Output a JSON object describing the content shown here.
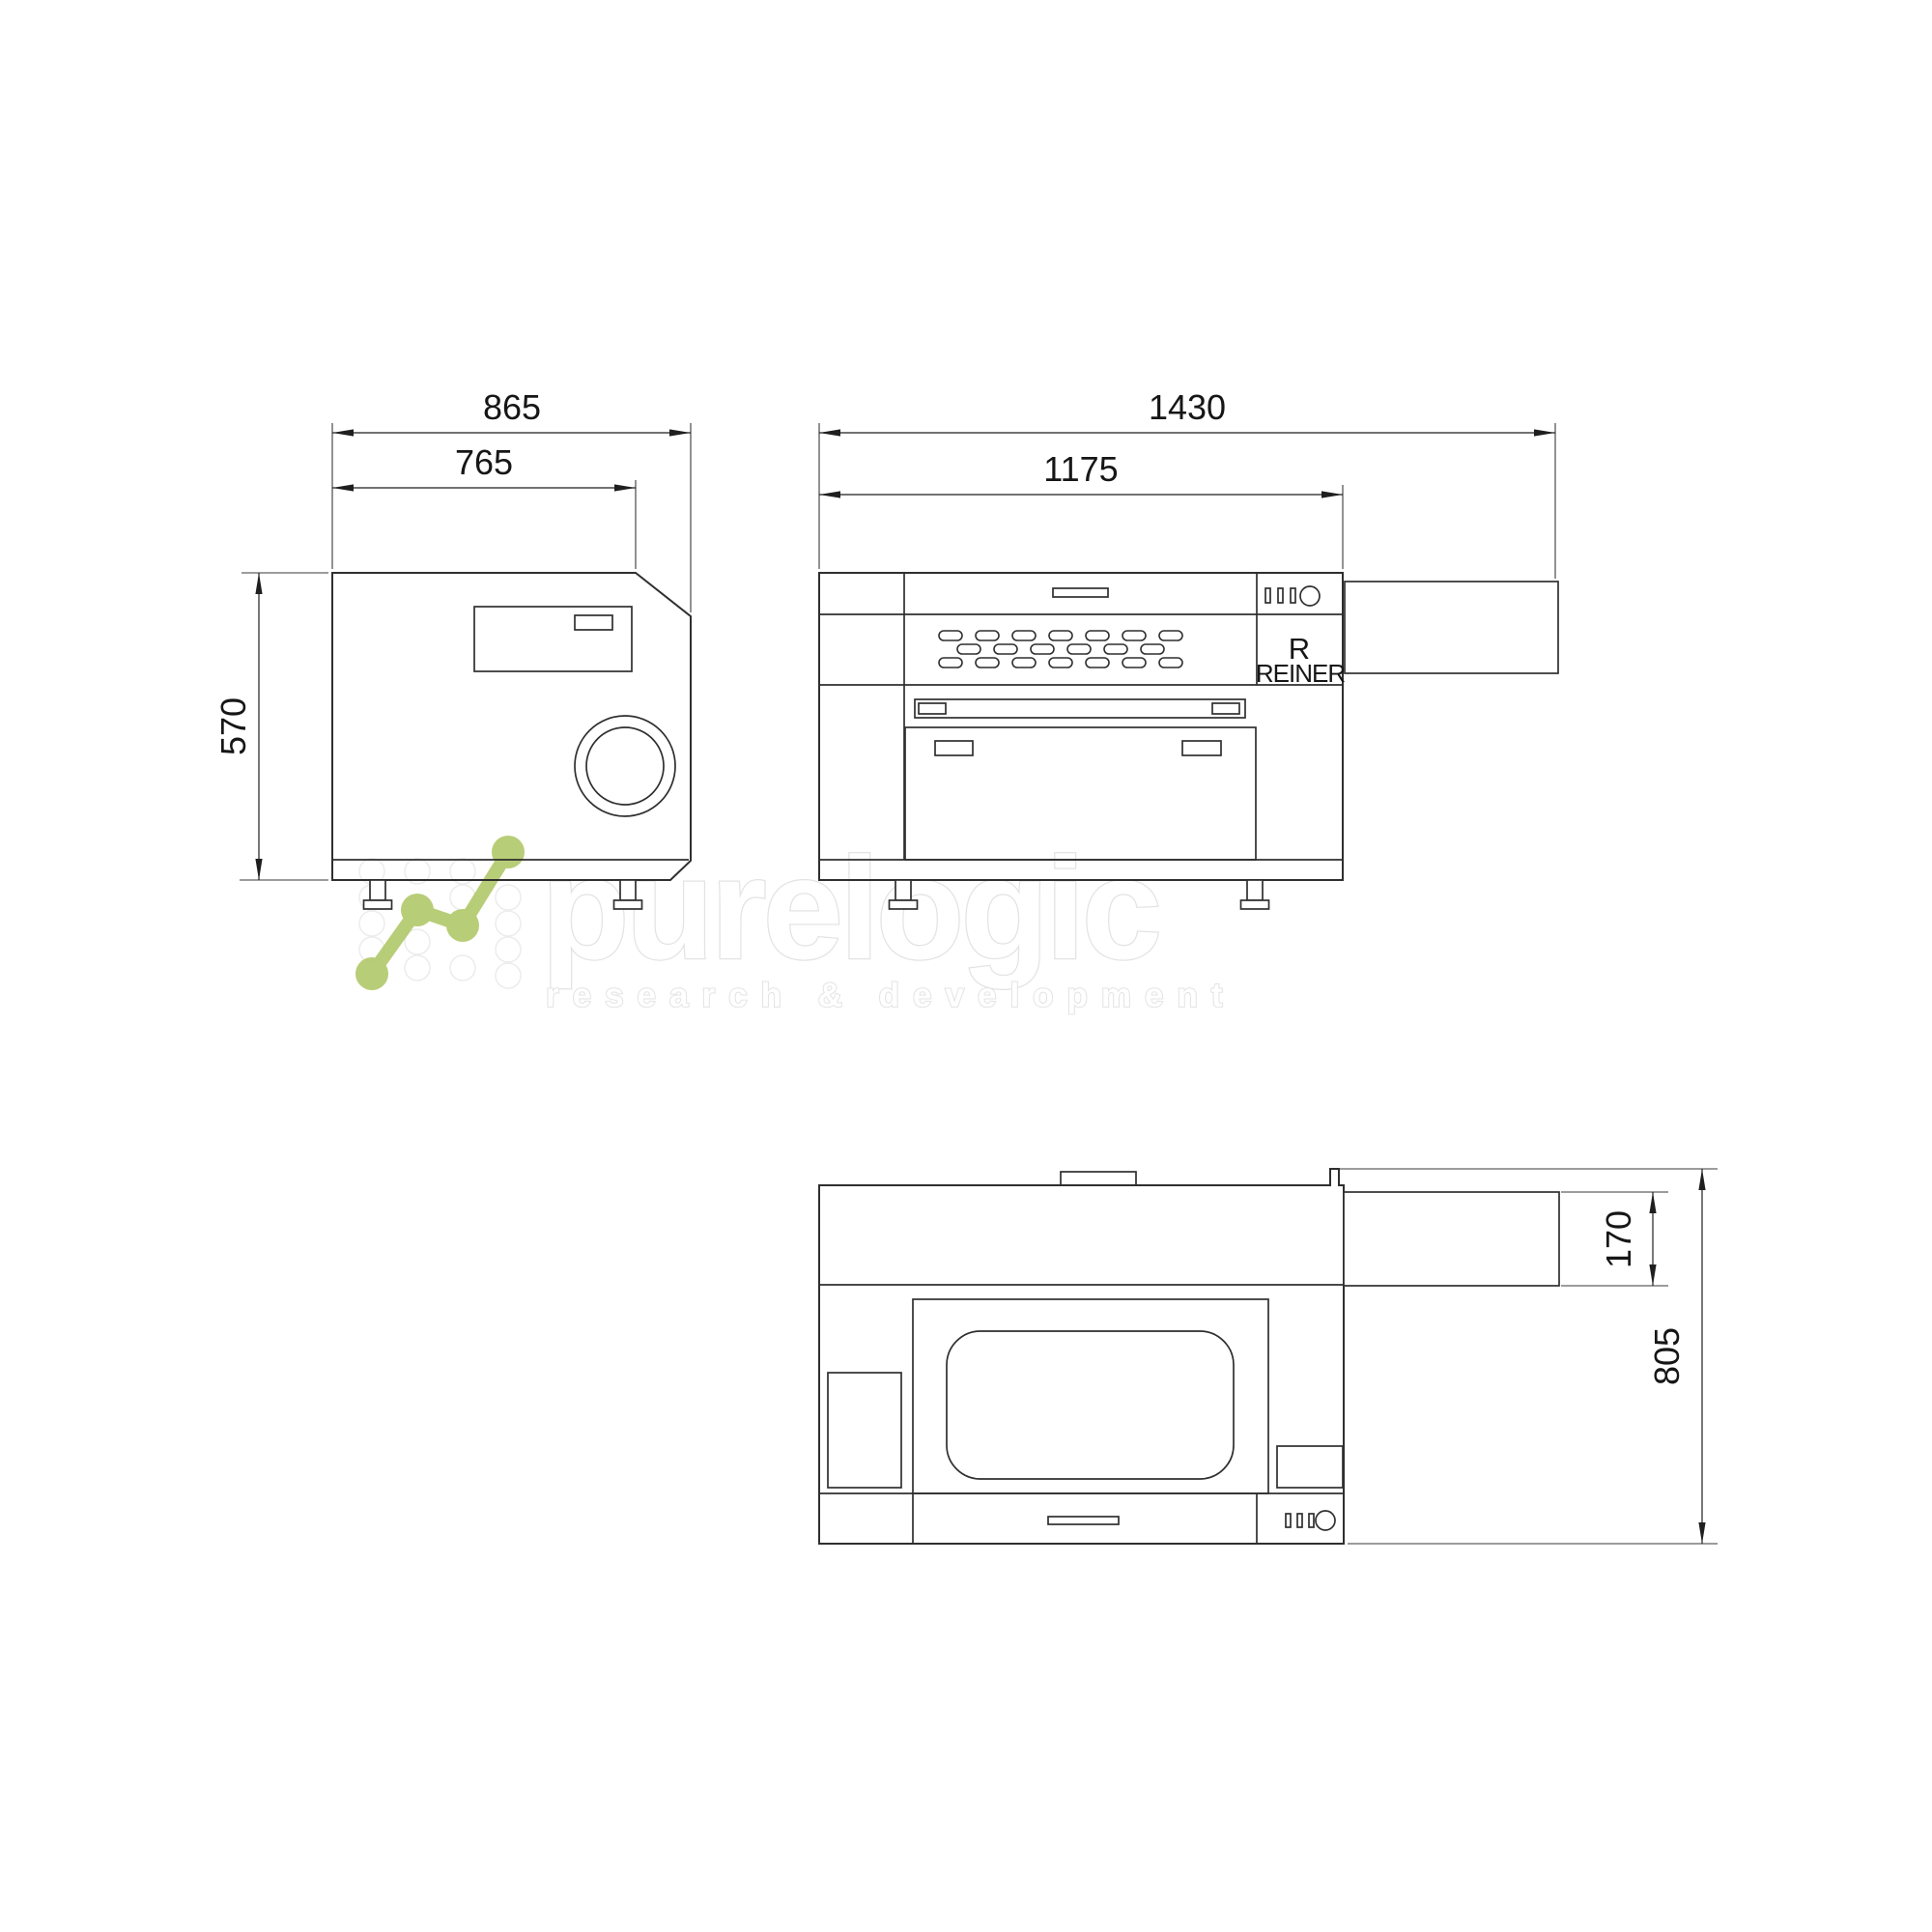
{
  "page": {
    "background": "#ffffff",
    "type": "technical-dimension-drawing"
  },
  "drawing": {
    "line_color": "#2f2f2f",
    "dim_color": "#1f1f1f",
    "views": {
      "side": {
        "label": "side-view",
        "dims": {
          "width_overall": "865",
          "width_top": "765",
          "height": "570"
        }
      },
      "front": {
        "label": "front-view",
        "dims": {
          "width_overall": "1430",
          "width_body": "1175"
        },
        "brand_mark": "R",
        "brand_name": "REINER"
      },
      "top": {
        "label": "top-view",
        "dims": {
          "table_depth": "170",
          "depth_overall": "805"
        }
      }
    }
  },
  "watermark": {
    "logo_text": "purelogic",
    "tagline": "research & development",
    "accent_green": "#b2c96c"
  }
}
